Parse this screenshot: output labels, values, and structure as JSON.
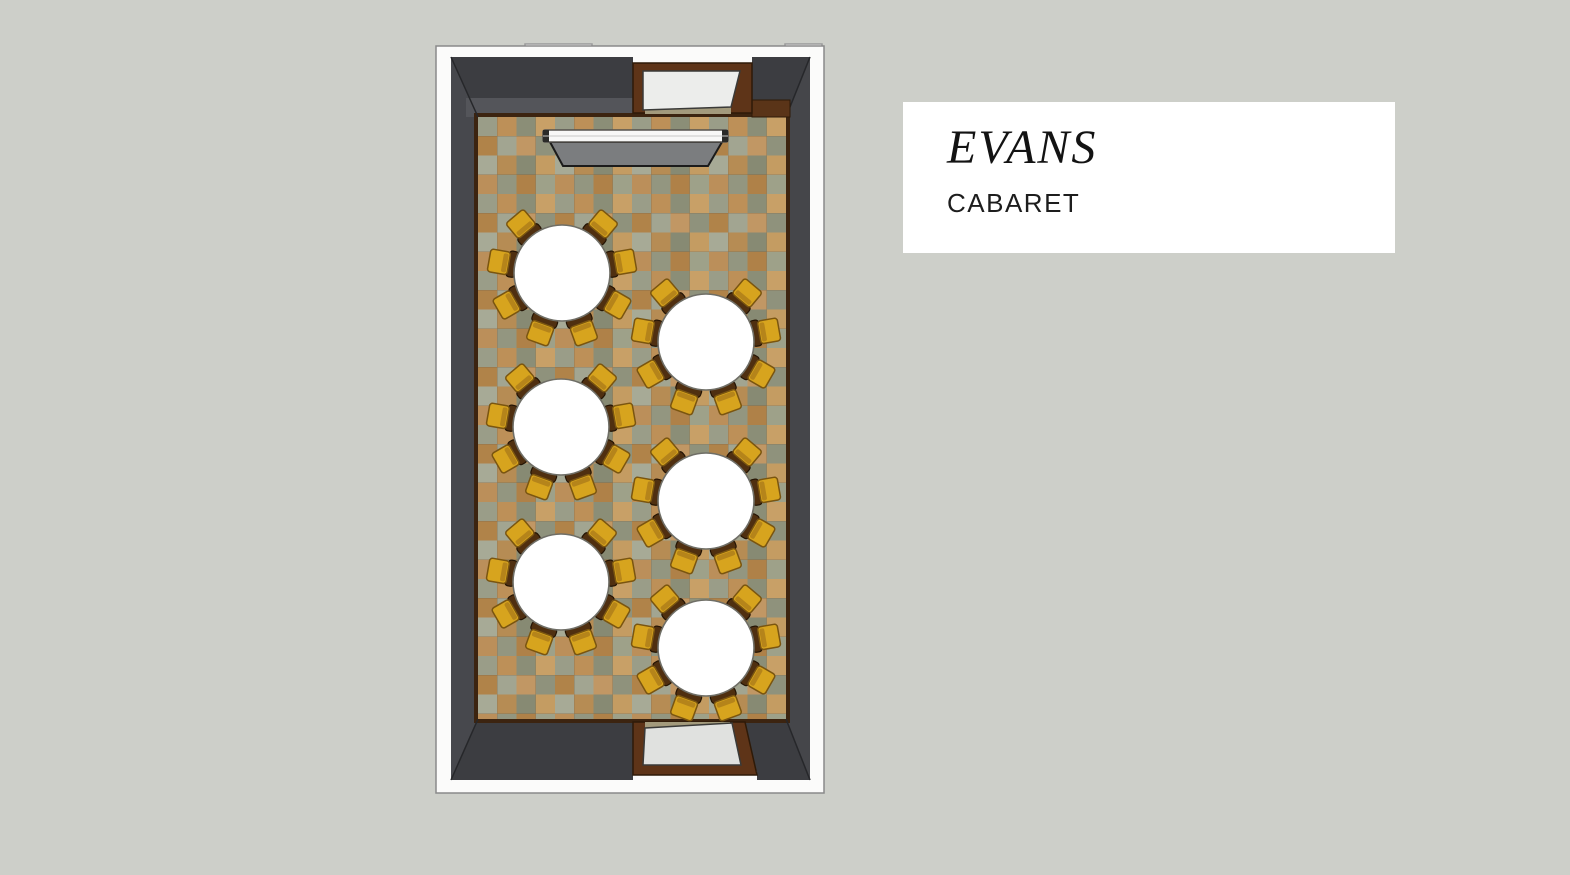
{
  "page": {
    "background_color": "#cdcfc9"
  },
  "label_card": {
    "title": "EVANS",
    "subtitle": "CABARET",
    "background_color": "#ffffff",
    "text_color": "#131313"
  },
  "floor_plan": {
    "layout_style": "Cabaret",
    "table_count": 6,
    "seats_per_table": 8,
    "table_radius": 48,
    "seat_distance": 62,
    "seat_angles_deg": [
      40,
      80,
      120,
      160,
      200,
      240,
      280,
      320
    ],
    "tables": [
      {
        "cx": 562,
        "cy": 273
      },
      {
        "cx": 706,
        "cy": 342
      },
      {
        "cx": 561,
        "cy": 427
      },
      {
        "cx": 706,
        "cy": 501
      },
      {
        "cx": 561,
        "cy": 582
      },
      {
        "cx": 706,
        "cy": 648
      }
    ],
    "colors": {
      "table_fill": "#ffffff",
      "table_stroke": "#6f6e66",
      "chair_seat": "#d7a41e",
      "chair_seat_shadow": "#b5841a",
      "chair_seat_stroke": "#7a5510",
      "chair_back": "#4f2f10",
      "chair_back_stroke": "#241404",
      "wall": "#3c3d41",
      "wall_side": "#47484d",
      "door_frame": "#5e3418",
      "floor_tan": "#bd9058",
      "floor_green": "#9a9d88"
    }
  }
}
